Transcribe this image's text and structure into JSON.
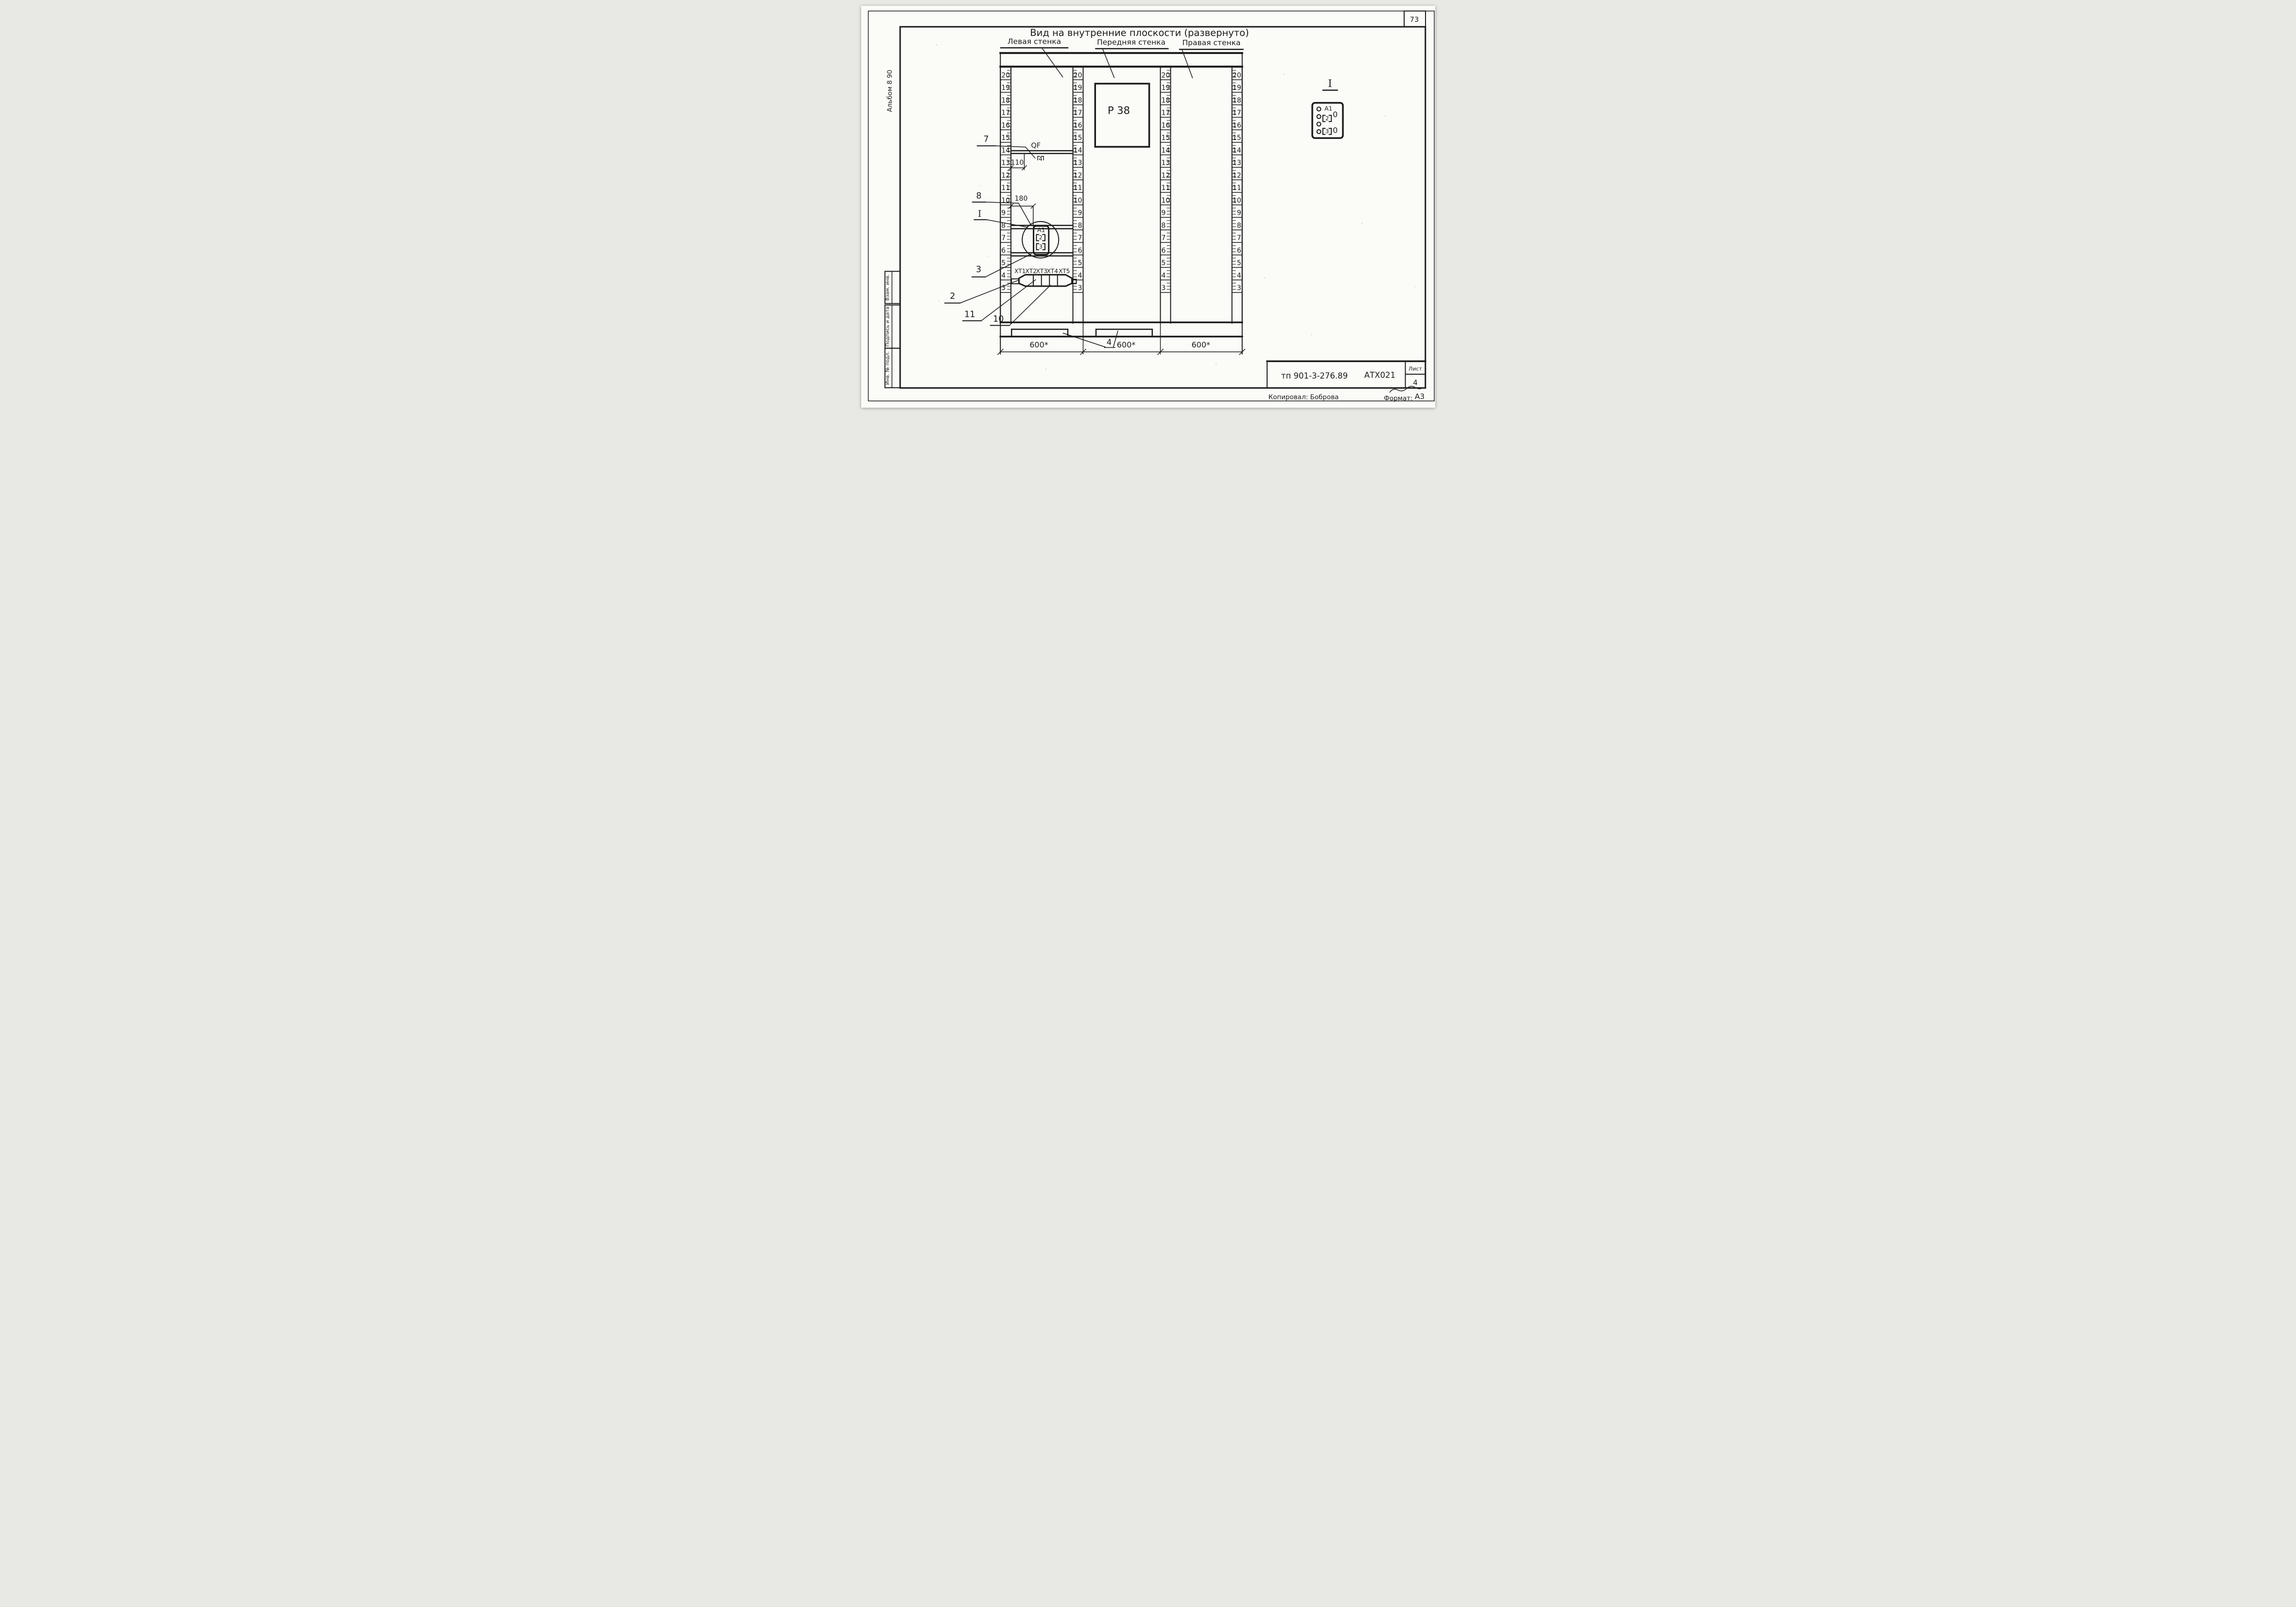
{
  "sheet": {
    "page_number": "73",
    "album_note": "Альбом 8 90",
    "stamp_sidebar": [
      "Взам. инв.",
      "Подпись и дата",
      "Инв. № подл."
    ],
    "title_block": {
      "doc_code": "тп 901-3-276.89",
      "mark": "АТХ021",
      "sheet_label": "Лист",
      "sheet_value": "4",
      "copied_by": "Копировал: Боброва",
      "format_label": "Формат:",
      "format_value": "А3"
    }
  },
  "drawing": {
    "title": "Вид на внутренние плоскости (развернуто)",
    "wall_labels": [
      "Левая стенка",
      "Передняя стенка",
      "Правая стенка"
    ],
    "ruler_numbers": [
      20,
      19,
      18,
      17,
      16,
      15,
      14,
      13,
      12,
      11,
      10,
      9,
      8,
      7,
      6,
      5,
      4,
      3
    ],
    "left_wall": {
      "breaker_label": "QF",
      "rail_marker": "4",
      "dim_110": "110",
      "dim_180": "180",
      "device_label": "А1",
      "device_slots": [
        "2",
        "3"
      ],
      "terminal_labels": [
        "ХТ1",
        "ХТ2",
        "ХТ3",
        "ХТ4",
        "ХТ5"
      ]
    },
    "front_wall": {
      "panel_label": "Р 38"
    },
    "callouts": {
      "c7": "7",
      "c8": "8",
      "cI": "I",
      "c3": "3",
      "c2": "2",
      "c11": "11",
      "c10": "10",
      "c4": "4"
    },
    "dims_bottom": [
      "600*",
      "600*",
      "600*"
    ],
    "detail": {
      "title": "I",
      "device_label": "А1",
      "slots": [
        "2",
        "3"
      ],
      "lamps": [
        "0",
        "0"
      ]
    }
  }
}
